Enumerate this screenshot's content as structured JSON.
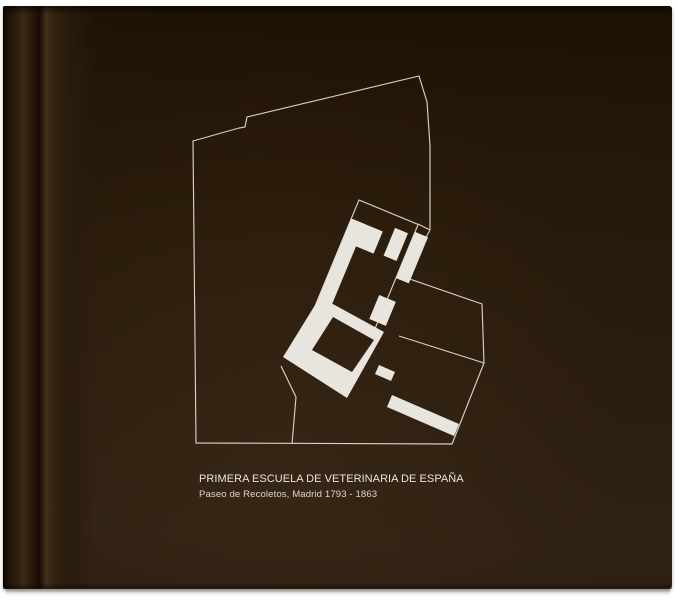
{
  "page": {
    "kind": "book page with architectural site plan",
    "background_white": "#ffffff",
    "cover_color": "#291b0b",
    "spine_highlight": "#44301a"
  },
  "caption": {
    "title": "PRIMERA ESCUELA DE VETERINARIA DE ESPAÑA",
    "subtitle": "Paseo de Recoletos, Madrid 1793 - 1863"
  },
  "plan": {
    "ink_fill": "#e8e4de",
    "line_color": "#d8d1c7",
    "line_width": 1.15,
    "rotation_deg": 22.5,
    "pivot": [
      359,
      200
    ],
    "site_outline": "419,76 427,102 430,146 430,230 404,277 482,304 484,363 452,444 196,443 193,141 239,128 245,127 247,117",
    "parcel_lines": [
      "399,336 484,363",
      "281,366 296,397 292,444",
      "418,224 430,230"
    ],
    "wing_outline": {
      "x": 0,
      "y": 0,
      "w": 64,
      "h": 114
    },
    "buildings_local": [
      {
        "x": 2,
        "y": 20,
        "w": 32,
        "h": 24
      },
      {
        "x": 44,
        "y": 12,
        "w": 14,
        "h": 30
      },
      {
        "x": 0,
        "y": 20,
        "w": 15,
        "h": 98
      },
      {
        "x": 64,
        "y": 8,
        "w": 14,
        "h": 50
      },
      {
        "x": 55,
        "y": 80,
        "w": 18,
        "h": 26
      }
    ],
    "courtyard_ring": {
      "outer": "320,297 384,332 347,398 283,357",
      "hole": "333,317 374,340 352,372 312,350"
    },
    "buildings_screen": [
      "379,365 395,372 391,381 375,374",
      "392,395 459,424 454,436 387,407"
    ]
  }
}
